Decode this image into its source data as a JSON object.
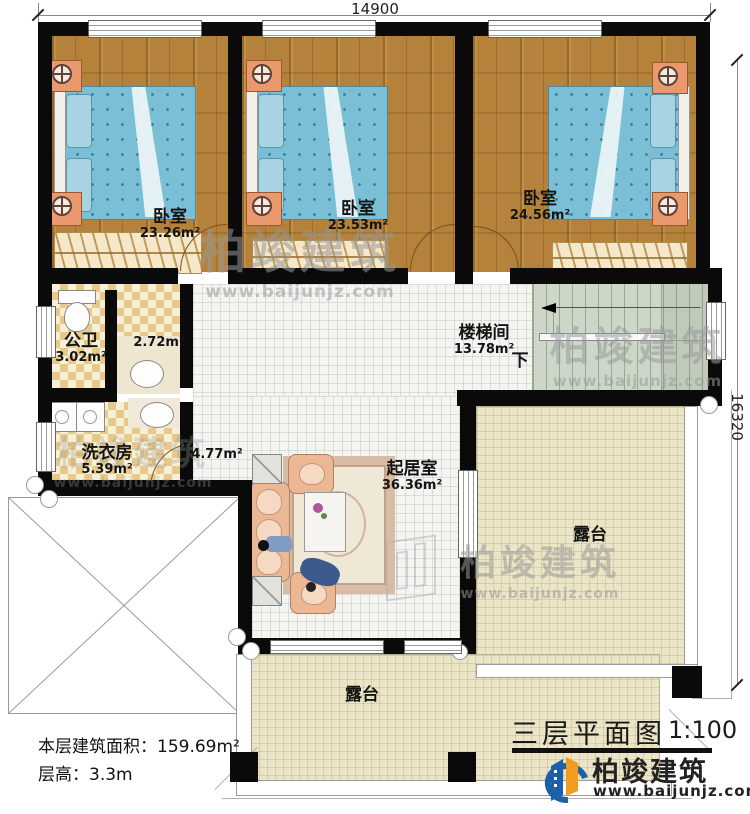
{
  "plan": {
    "dim_top": "14900",
    "dim_right": "16320",
    "rooms": {
      "bedroom1": {
        "name": "卧室",
        "area": "23.26m²"
      },
      "bedroom2": {
        "name": "卧室",
        "area": "23.53m²"
      },
      "bedroom3": {
        "name": "卧室",
        "area": "24.56m²"
      },
      "bathroom": {
        "name": "公卫",
        "area": "3.02m²"
      },
      "vanity": {
        "area": "2.72m²"
      },
      "laundry": {
        "name": "洗衣房",
        "area": "5.39m²"
      },
      "hall": {
        "area": "4.77m²"
      },
      "stairwell": {
        "name": "楼梯间",
        "area": "13.78m²",
        "down": "下"
      },
      "living": {
        "name": "起居室",
        "area": "36.36m²"
      },
      "terrace_right": {
        "name": "露台"
      },
      "terrace_bottom": {
        "name": "露台"
      }
    }
  },
  "notes": {
    "floor_area_label": "本层建筑面积：",
    "floor_area_value": "159.69m²",
    "floor_height_label": "层高：",
    "floor_height_value": "3.3m"
  },
  "title_block": {
    "title": "三层平面图",
    "scale": "1:100"
  },
  "brand": {
    "name": "柏竣建筑",
    "url": "www.baijunjz.com"
  },
  "watermark": {
    "name": "柏竣建筑",
    "url": "www.baijunjz.com"
  },
  "colors": {
    "wall": "#0a0a0a",
    "wood_floor": "#b5823b",
    "bed": "#7bbfd6",
    "tile_checker": "#e7c98c",
    "stair": "#cdd7c8",
    "terrace": "#ece4c6",
    "brand_blue": "#1d5fa8",
    "brand_orange": "#f29c1f"
  }
}
